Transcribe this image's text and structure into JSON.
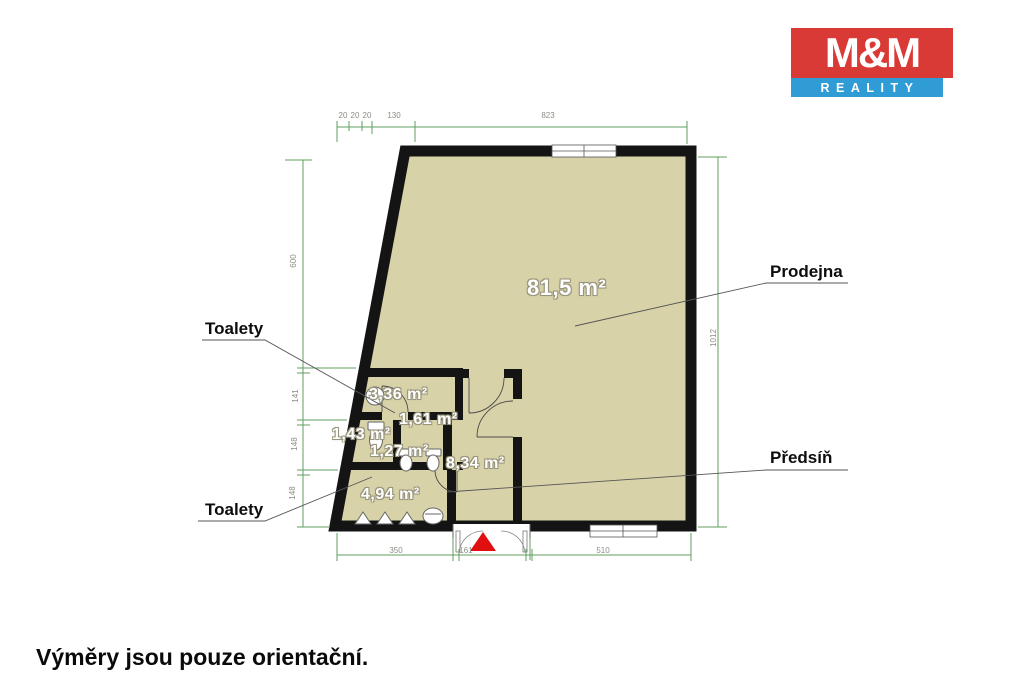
{
  "logo": {
    "top": "M&M",
    "bottom": "REALITY"
  },
  "note": "Výměry jsou pouze orientační.",
  "callouts": {
    "toalety_upper": "Toalety",
    "toalety_lower": "Toalety",
    "prodejna": "Prodejna",
    "predsin": "Předsíň"
  },
  "rooms": {
    "prodejna": "81,5 m²",
    "wc_336": "3,36 m²",
    "wc_161": "1,61 m²",
    "wc_143": "1,43 m²",
    "wc_127": "1,27 m²",
    "predsin": "8,34 m²",
    "chodba": "4,94 m²"
  },
  "dimensions": {
    "top": [
      "20",
      "20",
      "20",
      "130",
      "823"
    ],
    "left": [
      "600",
      "141",
      "148",
      "148"
    ],
    "right": [
      "1012"
    ],
    "bottom": [
      "350",
      "161",
      "510"
    ]
  },
  "colors": {
    "room_fill": "#d8d2a8",
    "wall": "#141414",
    "dimension": "#5f9f5f",
    "fixture_stroke": "#666666",
    "leader": "#555555",
    "entry_marker": "#e01010",
    "logo_red": "#d93a35",
    "logo_blue": "#2f9cd6"
  }
}
